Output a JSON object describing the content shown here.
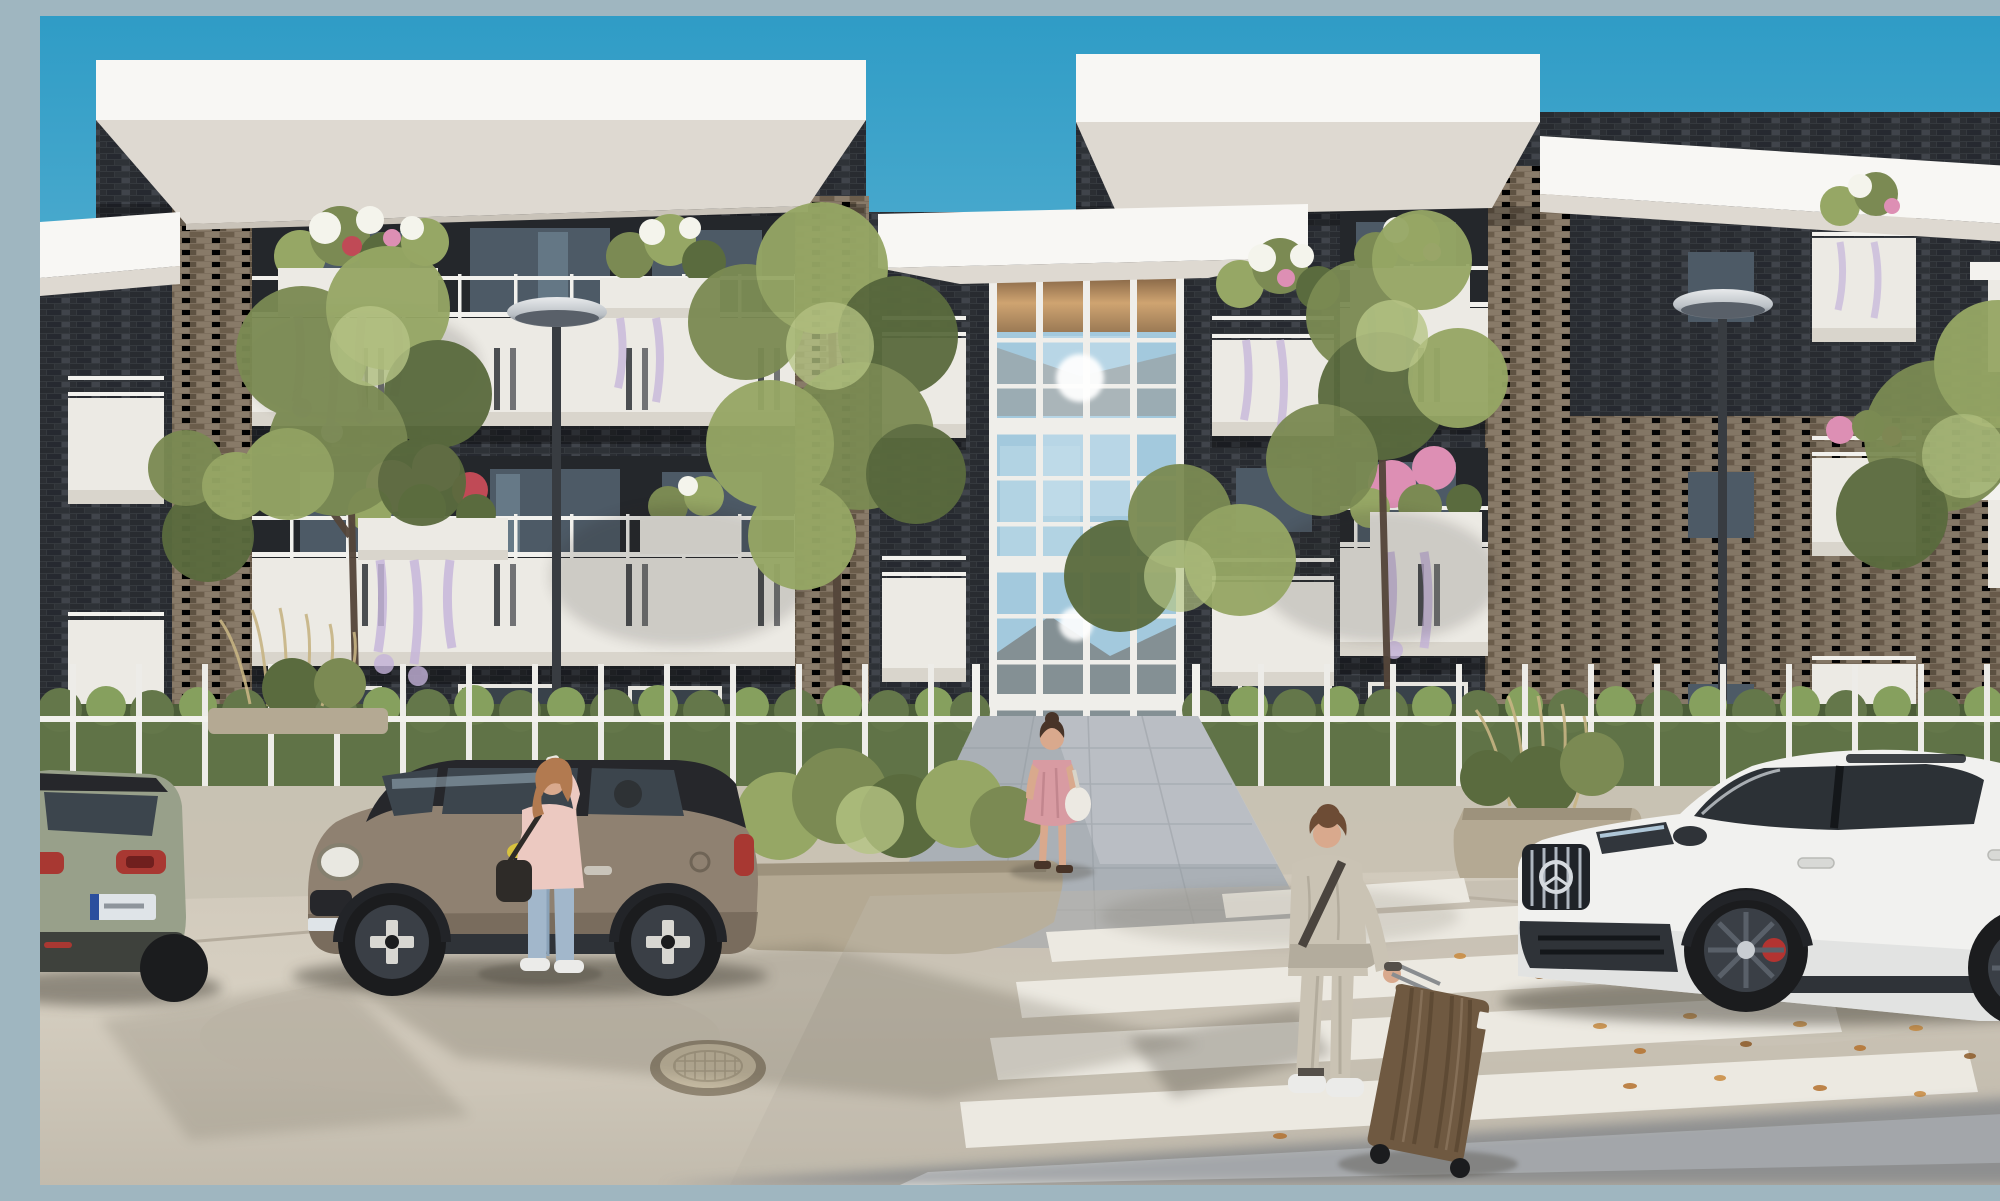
{
  "scene": {
    "title": "Modern apartment complex street view",
    "description": "Sunny architectural rendering of a modern three-storey apartment building with dark brick facade, white wrap-around balconies with flower planters and trailing wisteria, a full-height glazed entrance atrium reflecting the sky, a white fence with hedge, street lamps, parked cars (sage SUV rear, bronze Mini with black roof, white Mercedes coupe SUV), a woman on the phone beside the Mini, a woman in a pink dress walking to the entrance, a traveler in a beige suit pulling a wooden-look suitcase across a zebra crosswalk, concrete pavement with a manhole cover and scattered leaves under a clear blue sky.",
    "objects": [
      {
        "name": "sky",
        "description": "clear cyan-blue gradient sky"
      },
      {
        "name": "apartment-building",
        "description": "dark brick modern block, white roof slabs with deep overhangs"
      },
      {
        "name": "balcony-rows",
        "description": "white parapet balconies with thin steel railings and joint slots"
      },
      {
        "name": "flower-planters",
        "description": "white planter boxes with white/pink/red blooms and trailing lavender wisteria"
      },
      {
        "name": "entrance-atrium",
        "description": "full-height white-mullioned glass wall with amber clerestory, sun glints and lit lobby"
      },
      {
        "name": "street-lamp-left",
        "description": "grey pole lamp with elliptical head"
      },
      {
        "name": "street-lamp-right",
        "description": "grey pole lamp with elliptical head"
      },
      {
        "name": "trees",
        "description": "airy green street trees in front of the facade"
      },
      {
        "name": "hedge-fence",
        "description": "trimmed hedge with slim white fence posts and rail"
      },
      {
        "name": "stone-planters",
        "description": "raised stone planter beds with shrubs and ornamental grasses"
      },
      {
        "name": "suv-rear",
        "description": "sage-green SUV rear with red taillights and EU plate, left edge"
      },
      {
        "name": "mini-cooper",
        "description": "bronze-grey Mini with black roof, yellow mirror cap, white cross wheels"
      },
      {
        "name": "mercedes-suv",
        "description": "white Mercedes AMG coupe SUV, chrome grille, red brake calipers"
      },
      {
        "name": "woman-on-phone",
        "description": "woman in pink top and light jeans talking on phone by the Mini"
      },
      {
        "name": "woman-walking-entrance",
        "description": "woman in rose dress with white handbag walking toward lobby"
      },
      {
        "name": "traveler-with-suitcase",
        "description": "person in beige suit pulling a wood-grain trolley suitcase"
      },
      {
        "name": "zebra-crosswalk",
        "description": "white zebra stripes crossing the foreground to the right"
      },
      {
        "name": "manhole-cover",
        "description": "round tan manhole cover set in concrete"
      },
      {
        "name": "pavement",
        "description": "warm light concrete with tree shadows and orange leaf litter"
      },
      {
        "name": "corner-shadow",
        "description": "cool shadow wedge across the bottom-right corner"
      }
    ]
  },
  "colors": {
    "sky_top": "#2f9cc6",
    "sky_low": "#8fc9df",
    "roof_white": "#f3f2ee",
    "fascia_bright": "#f8f7f4",
    "soffit": "#ded9d1",
    "soffit_dark": "#c9c3b9",
    "brick_bg": "#35393e",
    "brick_a": "#282b30",
    "brick_b": "#2e3237",
    "brick_hi": "#474b52",
    "tan_bg": "#7d6f5e",
    "tan_a": "#6b5d4b",
    "tan_b": "#8a7c6a",
    "tan_c": "#5e5242",
    "parapet": "#eceae4",
    "parapet_sh": "#d9d5cc",
    "railing": "#f2f1ed",
    "recess": "#24272b",
    "door_glass": "#4d5a66",
    "door_glass_lt": "#7c93a3",
    "mullion": "#efeeea",
    "glass_blue": "#a3c9dd",
    "glass_light": "#c6dfec",
    "amber_hi": "#cfa471",
    "amber_lo": "#7e5f41",
    "hedge": "#64774a",
    "hedge_dark": "#4c5d38",
    "hedge_light": "#86a05e",
    "leaf1": "#7b8a53",
    "leaf2": "#96a765",
    "leaf3": "#5a6b3e",
    "leaf4": "#b5c483",
    "trunk": "#54453a",
    "stone": "#b4a993",
    "stone_dark": "#978c77",
    "paver": "#aab0b6",
    "paver_light": "#c6cbcf",
    "pavement_hi": "#d6cfc1",
    "pavement_lo": "#c2bbad",
    "stripe": "#ece9e1",
    "lamp_pole": "#383c41",
    "lamp_silver": "#d4d6d8",
    "lamp_under": "#596069",
    "skin": "#d9a98d",
    "hair_red": "#b27a50",
    "hair_brown": "#6d4c35",
    "hair_dark": "#483428",
    "top_pink": "#ecc9c1",
    "jeans": "#a2b7cb",
    "dress": "#d89ba2",
    "bag_white": "#ece9e2",
    "bag_dark": "#2e2b28",
    "suit": "#cac3b4",
    "suit_sh": "#b3ac9d",
    "case": "#6f5941",
    "case_grain": "#57442f",
    "case_hi": "#8b745c",
    "shoe": "#ebebe9",
    "mini_body": "#8f8171",
    "mini_shade": "#6f6456",
    "mini_accent": "#d8c23e",
    "car_roof": "#26272b",
    "car_glass": "#3c454d",
    "suv_body": "#98a08a",
    "taillight": "#a83832",
    "plate": "#dfe4e8",
    "plate_blue": "#2b4f9e",
    "bumper": "#3e413c",
    "merc_body": "#f1f1ef",
    "merc_shade": "#d9dad8",
    "merc_glass": "#2c3136",
    "grille": "#1f2328",
    "chrome": "#c8cdd2",
    "tire": "#1b1c1e",
    "rim_light": "#d8d7d2",
    "rim_dark": "#3a3f46",
    "caliper": "#b23431",
    "dark_trim": "#2f3338",
    "shadow": "#4a443a",
    "wisteria": "#c4b3da",
    "flower_white": "#f4f4ec",
    "flower_pink": "#dd8fb4",
    "flower_red": "#c04a56",
    "grass_tan": "#c6b483"
  }
}
